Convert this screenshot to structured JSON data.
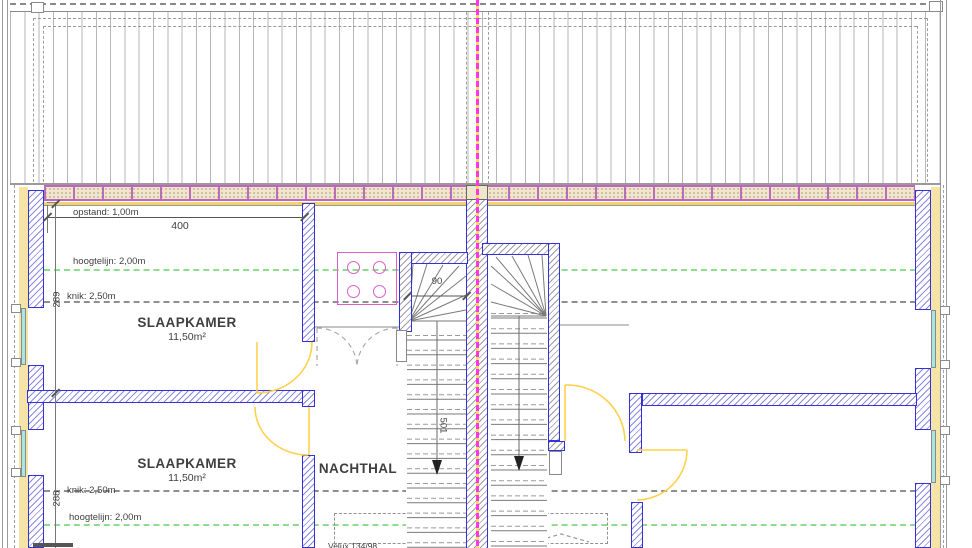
{
  "drawing": {
    "rooms": [
      {
        "name": "SLAAPKAMER",
        "area": "11,50m²"
      },
      {
        "name": "SLAAPKAMER",
        "area": "11,50m²"
      },
      {
        "name": "NACHTHAL"
      }
    ],
    "annotations": {
      "opstand": "opstand: 1,00m",
      "hoogtelijn_upper": "hoogtelijn: 2,00m",
      "knik_upper": "knik: 2,50m",
      "knik_lower": "knik: 2,50m",
      "hoogtelijn_lower": "hoogtelijn: 2,00m",
      "velux_label": "Velux 134/98"
    },
    "dimensions": {
      "plan_width": "400",
      "upper_room_depth": "289",
      "lower_room_depth": "288",
      "stair_width": "90",
      "stair_run": "501"
    },
    "colors": {
      "wall_outline_blue": "#3232d8",
      "insulation_yellow": "#f6e3a6",
      "brick_fill": "#efe6cd",
      "brick_joint_magenta": "#c064c0",
      "axis_magenta": "#ff35e8",
      "axis_yellow_dash": "#ffdf52",
      "door_swing_yellow": "#ffd14f",
      "hoogtelijn_green": "#8edc8e",
      "knik_gray": "#8f8f8f",
      "glazing_cyan": "#a8e7e0",
      "rooflight_pink": "#da5ec8"
    }
  }
}
